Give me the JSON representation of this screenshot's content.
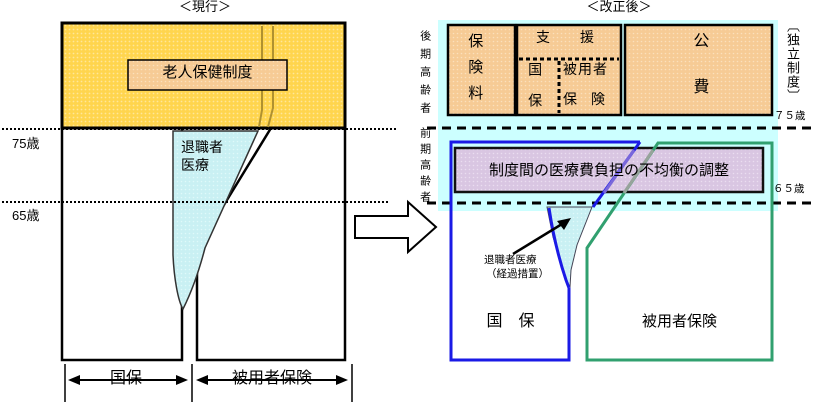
{
  "left": {
    "title": "＜現行＞",
    "elderly_system": "老人保健制度",
    "retiree_line1": "退職者",
    "retiree_line2": "医療",
    "age75": "75歳",
    "age65": "65歳",
    "kokuho": "国保",
    "employee": "被用者保険"
  },
  "right": {
    "title": "＜改正後＞",
    "late_elderly": "後期高齢者",
    "early_elderly": "前期高齢者",
    "premium": "保険料",
    "support": "支　援",
    "support_kokuho": "国保",
    "support_employee1": "被用者",
    "support_employee2": "保　険",
    "public_expense": "公費",
    "independent": "〔独立制度〕",
    "age75": "７５歳",
    "age65": "６５歳",
    "adjustment": "制度間の医療費負担の不均衡の調整",
    "retiree_note1": "退職者医療",
    "retiree_note2": "（経過措置）",
    "kokuho": "国　保",
    "employee": "被用者保険"
  },
  "colors": {
    "yellow": "#FFD54E",
    "yellow_dot": "#FFE79A",
    "orange": "#F6CB95",
    "orange_dot": "#FBE0BC",
    "cyan_band": "#CCFFFF",
    "wedge_cyan": "#C9F0F3",
    "wedge_cyan_dot": "#DFF9FA",
    "purple": "#D9C6E2",
    "purple_dot": "#EADDF0",
    "blue_outline": "#1A1AE6",
    "green_outline": "#31A06F",
    "olive_line": "#B0912F"
  }
}
